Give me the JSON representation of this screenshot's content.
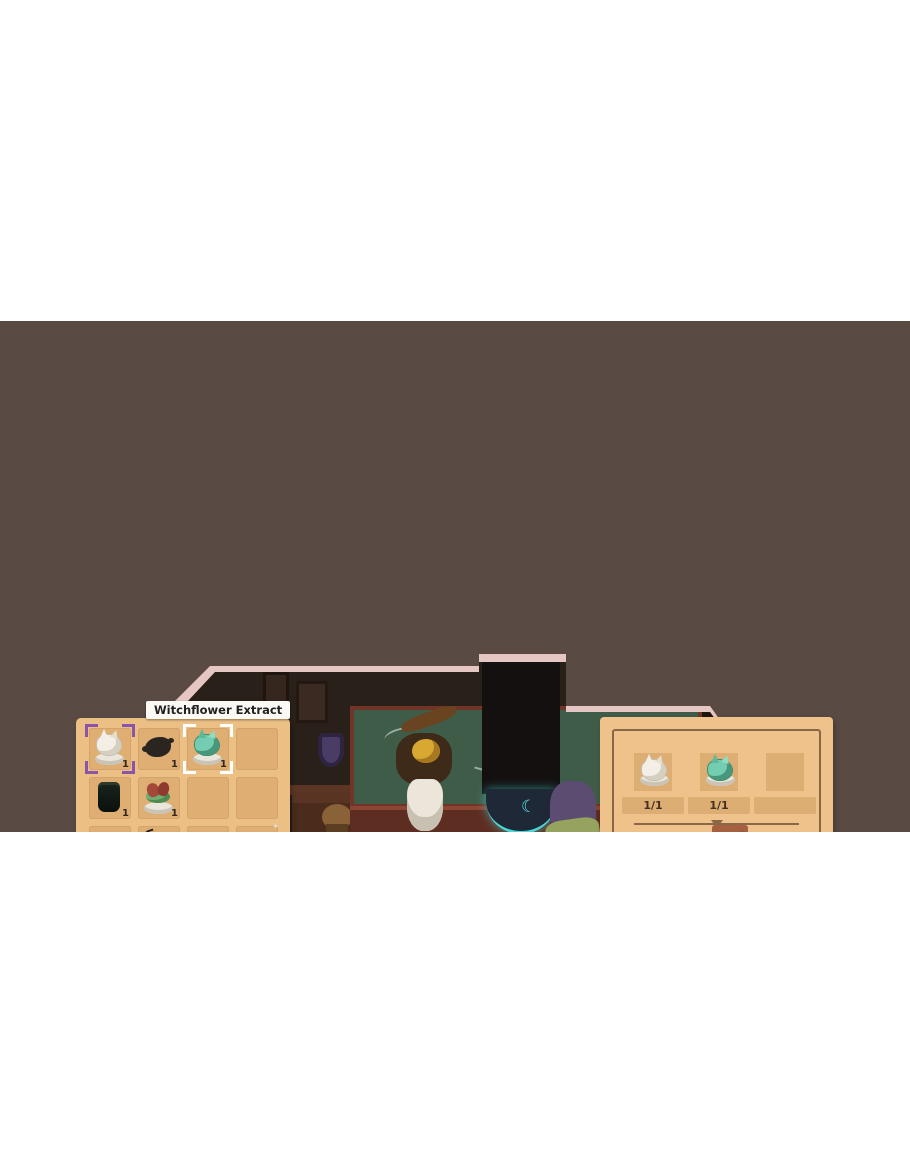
{
  "tooltip": {
    "text": "Witchflower Extract"
  },
  "inventory": {
    "slots": [
      {
        "type": "extract-white",
        "count": "1",
        "selected": "purple"
      },
      {
        "type": "ink-splat",
        "count": "1"
      },
      {
        "type": "extract-teal",
        "count": "1",
        "selected": "white"
      },
      {
        "type": "empty"
      },
      {
        "type": "jar-dark",
        "count": "1"
      },
      {
        "type": "dish-red",
        "count": "1"
      },
      {
        "type": "empty"
      },
      {
        "type": "empty"
      },
      {
        "type": "mushrooms",
        "count": "5"
      },
      {
        "type": "beetle",
        "count": "1"
      },
      {
        "type": "feather",
        "count": "1"
      },
      {
        "type": "butterfly",
        "count": "1"
      },
      {
        "type": "locked"
      },
      {
        "type": "locked"
      },
      {
        "type": "locked"
      },
      {
        "type": "locked"
      },
      {
        "type": "locked"
      },
      {
        "type": "locked"
      },
      {
        "type": "locked"
      },
      {
        "type": "locked"
      },
      {
        "type": "locked"
      },
      {
        "type": "locked"
      },
      {
        "type": "locked"
      },
      {
        "type": "locked"
      }
    ]
  },
  "crafting": {
    "ingredients": [
      {
        "type": "extract-white",
        "qty": "1/1"
      },
      {
        "type": "extract-teal",
        "qty": "1/1"
      },
      {
        "type": "empty",
        "qty": ""
      }
    ],
    "gauge": {
      "segments": 5,
      "filled": 4,
      "needle_segment": 4,
      "min_flames": 1,
      "max_flames": 3
    },
    "controls": {
      "left": "rotate-clockwise",
      "middle": "forbidden",
      "right": "rotate-counterclockwise"
    },
    "craft_hint": {
      "label": "Press and Hold to Craft",
      "button": "A"
    }
  },
  "scene": {
    "use_prompt": {
      "button": "A",
      "label": "Use"
    }
  },
  "colors": {
    "band": "#594a44",
    "room_border": "#e6c6c3",
    "panel": "#ecc084",
    "slot": "#deae72",
    "gauge_filled": [
      "#9c5640",
      "#a15a42",
      "#a4603f",
      "#9e5840"
    ],
    "gauge_empty": "#d3c2a2",
    "select_purple": "#8a54a8",
    "select_white": "#ffffff",
    "accent_green": "#3db04c",
    "cauldron_liquid": "#49cf92"
  }
}
